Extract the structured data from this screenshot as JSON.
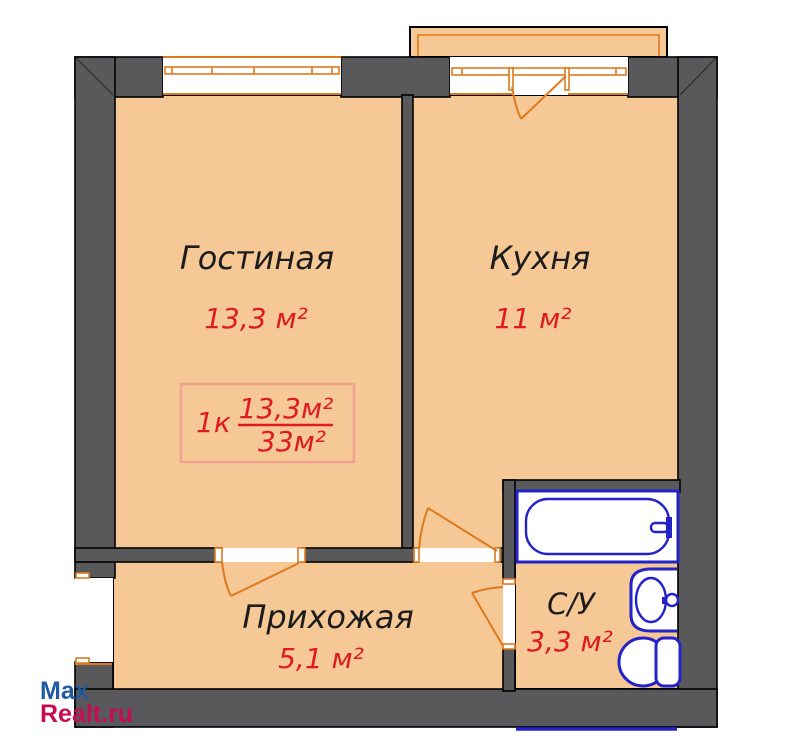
{
  "rooms": {
    "living": {
      "name": "Гостиная",
      "area": "13,3 м²"
    },
    "kitchen": {
      "name": "Кухня",
      "area": "11 м²"
    },
    "hallway": {
      "name": "Прихожая",
      "area": "5,1 м²"
    },
    "bathroom": {
      "name": "С/У",
      "area": "3,3 м²"
    }
  },
  "info_box": {
    "rooms_label": "1к",
    "room_area": "13,3м²",
    "total_area": "33м²"
  },
  "watermark": {
    "line1": "Max",
    "line2": "Realt.ru"
  },
  "colors": {
    "wall": "#59595B",
    "floor": "#F6C896",
    "joinery": "#DE7A1E",
    "fixture": "#2323C8",
    "area_red": "#DE1B21",
    "label_dark": "#1C1C1C",
    "box_border": "#EFA28C",
    "wm_blue": "#1E5AA0",
    "wm_red": "#C60D50"
  }
}
